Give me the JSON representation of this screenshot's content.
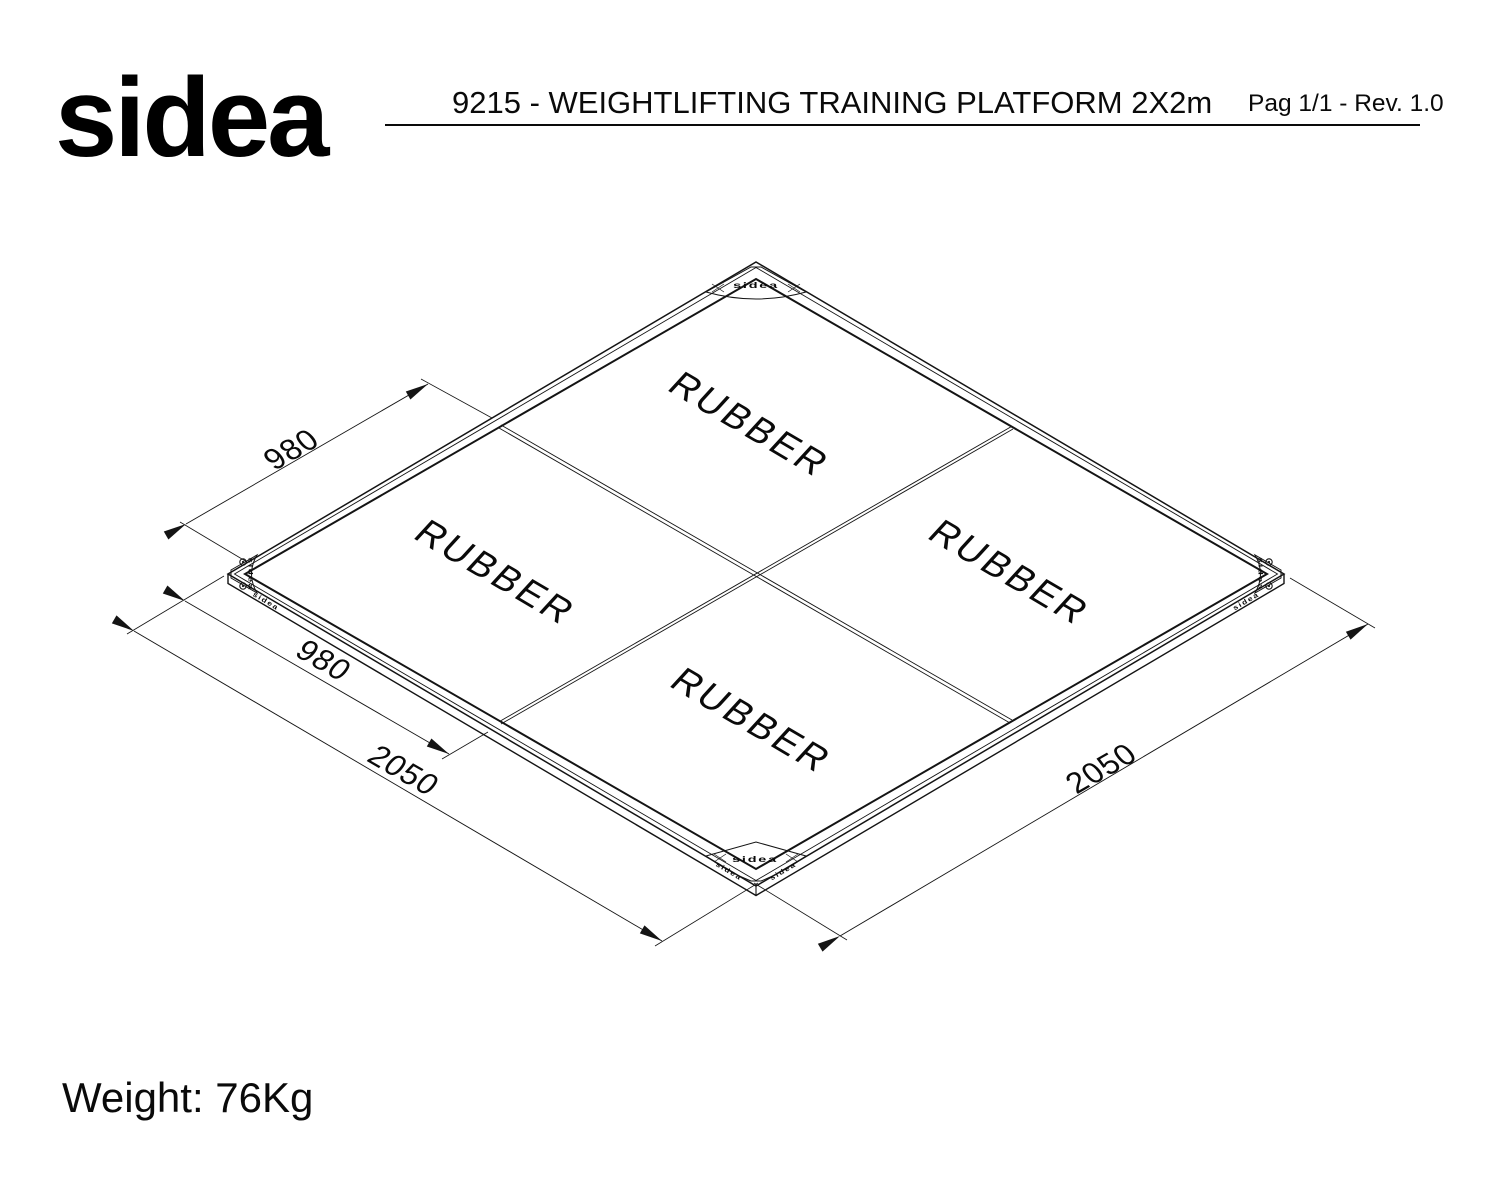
{
  "header": {
    "logo": "sidea",
    "title": "9215 - WEIGHTLIFTING TRAINING PLATFORM 2X2m",
    "page_info": "Pag 1/1 - Rev. 1.0"
  },
  "drawing": {
    "corner_brand": "sidea",
    "panels": {
      "top": "RUBBER",
      "left": "RUBBER",
      "right": "RUBBER",
      "bottom": "RUBBER"
    },
    "dimensions": {
      "panel_top": "980",
      "panel_left": "980",
      "edge_left": "2050",
      "edge_right": "2050"
    }
  },
  "footer": {
    "weight": "Weight: 76Kg"
  }
}
